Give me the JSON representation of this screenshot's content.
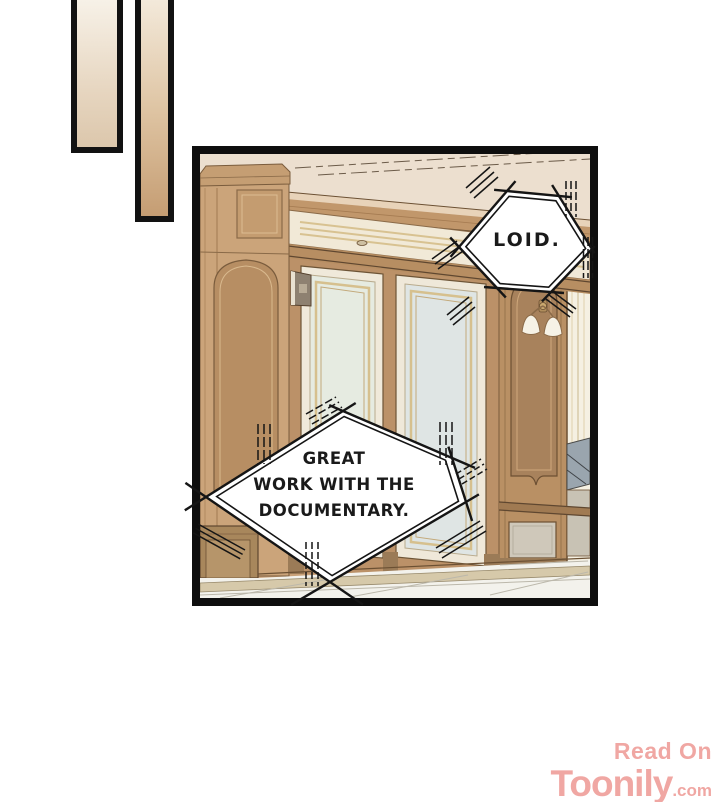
{
  "bubbles": {
    "loid": {
      "text": "LOID."
    },
    "great": {
      "line1": "GREAT",
      "line2": "WORK WITH THE",
      "line3": "DOCUMENTARY."
    }
  },
  "watermark": {
    "read_on": "Read On",
    "brand": "Toonily",
    "suffix": ".com"
  },
  "colors": {
    "panel_border": "#0e0e0e",
    "ink": "#1a1a1a",
    "bubble_fill": "#ffffff",
    "watermark_pink": "#f0a7a3",
    "ceiling_cream": "#ecdfcf",
    "wood_wall": "#c9a178",
    "door_glass": "#e3e9e4",
    "gold_trim": "#d6c08e",
    "floor_tile": "#f3f2ec",
    "bar1_gradient": [
      "#f8f3ea",
      "#dcc7ac"
    ],
    "bar2_gradient": [
      "#f4ebdd",
      "#c59d73"
    ]
  }
}
